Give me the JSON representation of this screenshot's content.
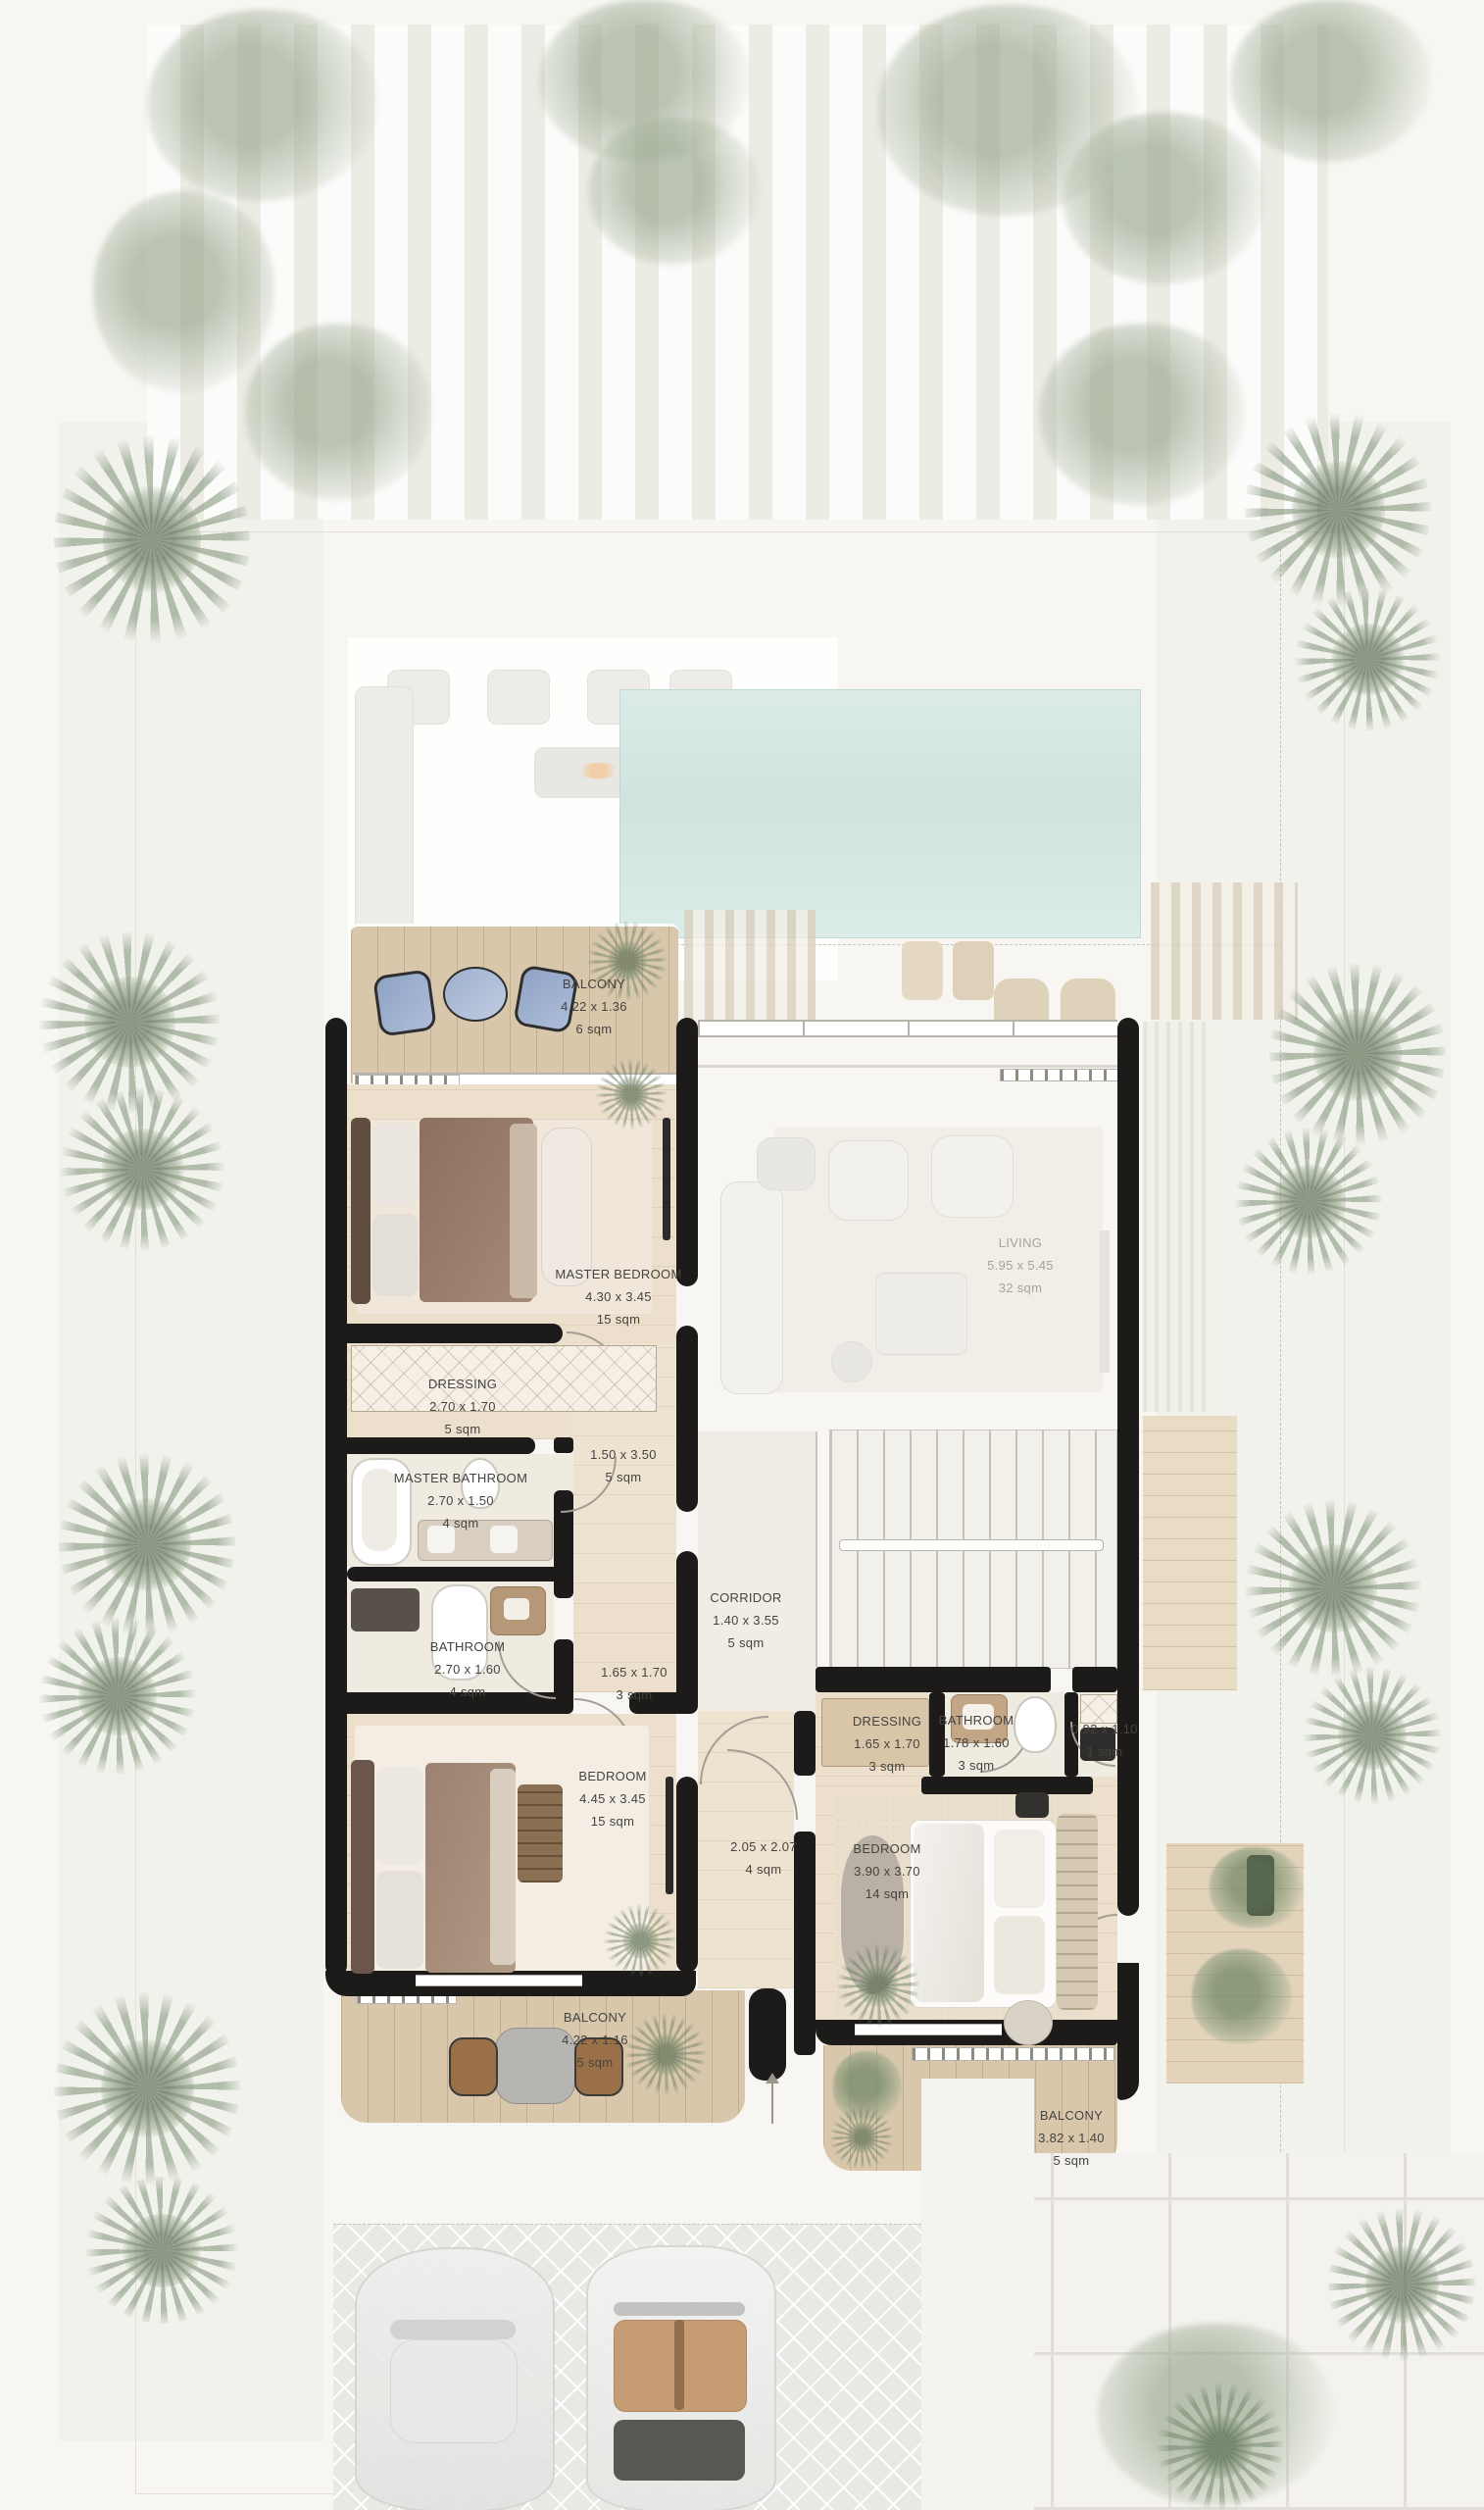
{
  "plan": {
    "type": "villa-first-floor-plan",
    "rooms": {
      "balcony_top": {
        "name": "BALCONY",
        "dims": "4.22 x 1.36",
        "area": "6 sqm"
      },
      "master_bedroom": {
        "name": "MASTER BEDROOM",
        "dims": "4.30 x 3.45",
        "area": "15 sqm"
      },
      "dressing_left": {
        "name": "DRESSING",
        "dims": "2.70 x 1.70",
        "area": "5 sqm"
      },
      "master_bathroom": {
        "name": "MASTER BATHROOM",
        "dims": "2.70 x 1.50",
        "area": "4 sqm"
      },
      "upper_hall": {
        "name": "",
        "dims": "1.50 x 3.50",
        "area": "5 sqm"
      },
      "bathroom_left": {
        "name": "BATHROOM",
        "dims": "2.70 x 1.60",
        "area": "4 sqm"
      },
      "vestibule_left": {
        "name": "",
        "dims": "1.65 x 1.70",
        "area": "3 sqm"
      },
      "corridor": {
        "name": "CORRIDOR",
        "dims": "1.40 x 3.55",
        "area": "5 sqm"
      },
      "bedroom_left": {
        "name": "BEDROOM",
        "dims": "4.45 x 3.45",
        "area": "15 sqm"
      },
      "dressing_right": {
        "name": "DRESSING",
        "dims": "1.65 x 1.70",
        "area": "3 sqm"
      },
      "bathroom_right": {
        "name": "BATHROOM",
        "dims": "1.78 x 1.60",
        "area": "3 sqm"
      },
      "wc_right": {
        "name": "",
        "dims": "0.92 x 1.10",
        "area": "1 sqm"
      },
      "hall_right": {
        "name": "",
        "dims": "2.05 x 2.07",
        "area": "4 sqm"
      },
      "bedroom_right": {
        "name": "BEDROOM",
        "dims": "3.90 x 3.70",
        "area": "14 sqm"
      },
      "balcony_bottom_left": {
        "name": "BALCONY",
        "dims": "4.22 x 1.16",
        "area": "5 sqm"
      },
      "balcony_bottom_right": {
        "name": "BALCONY",
        "dims": "3.82 x 1.40",
        "area": "5 sqm"
      },
      "living": {
        "name": "LIVING",
        "dims": "5.95 x 5.45",
        "area": "32 sqm"
      }
    },
    "colors": {
      "wall": "#1c1b19",
      "wood_deck": "#d9c7ac",
      "wood_floor": "#ecdfcb",
      "pool": "#d4e6e2",
      "greenery": "#8fa486",
      "label_text": "#45433f",
      "label_faded": "#a5a29c"
    }
  }
}
